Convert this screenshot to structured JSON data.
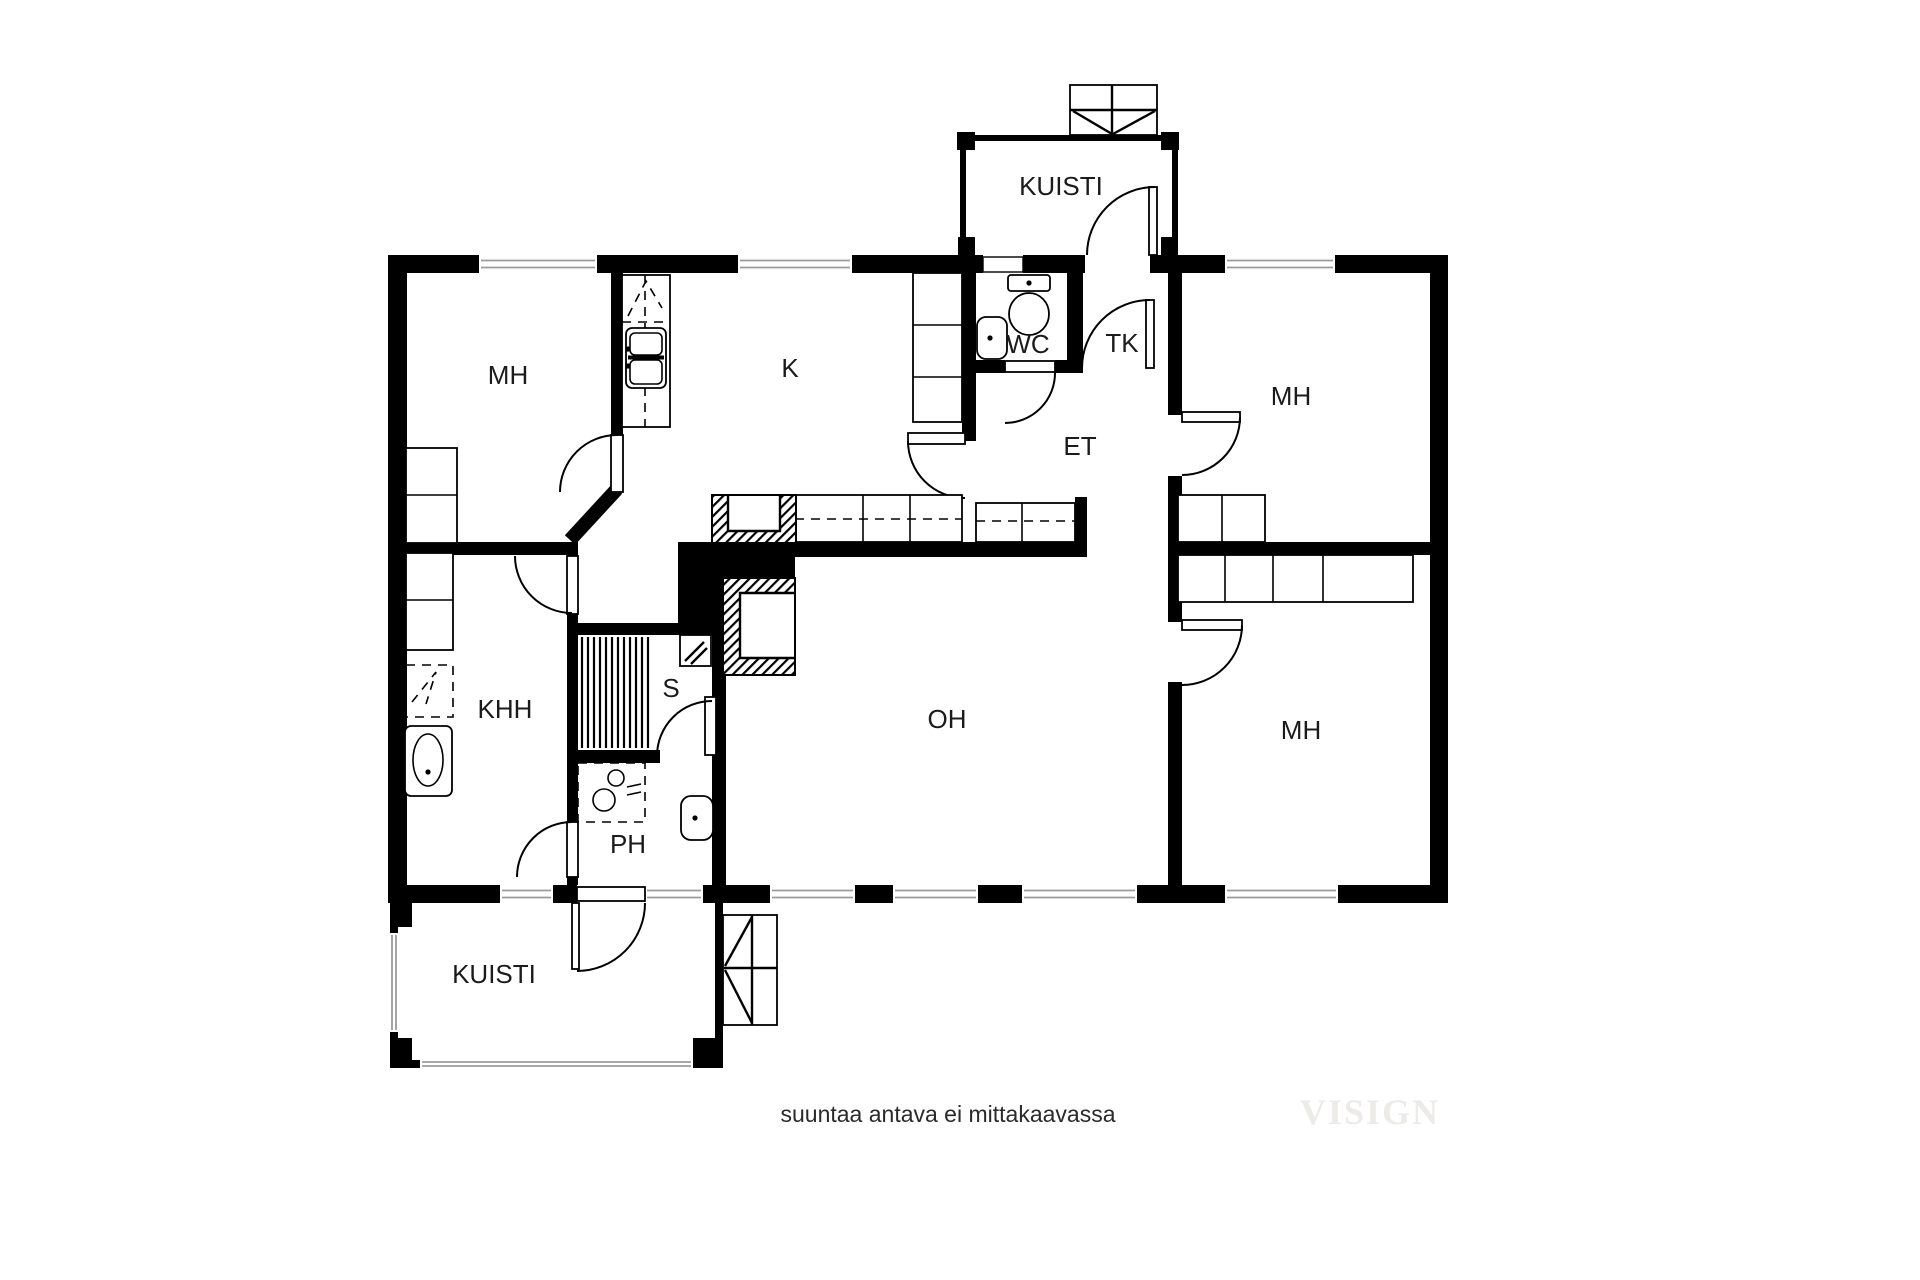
{
  "page": {
    "background": "#ffffff"
  },
  "colors": {
    "wall": "#000000",
    "floor": "#ffffff",
    "window_line": "#9b9b9b",
    "watermark": "#edebe8"
  },
  "rooms": {
    "mh_top_left": {
      "label": "MH"
    },
    "kitchen": {
      "label": "K"
    },
    "kuisti_top": {
      "label": "KUISTI"
    },
    "wc": {
      "label": "WC"
    },
    "tk": {
      "label": "TK"
    },
    "et": {
      "label": "ET"
    },
    "mh_top_right": {
      "label": "MH"
    },
    "khh": {
      "label": "KHH"
    },
    "sauna": {
      "label": "S"
    },
    "ph": {
      "label": "PH"
    },
    "oh": {
      "label": "OH"
    },
    "mh_bottom_right": {
      "label": "MH"
    },
    "kuisti_bottom": {
      "label": "KUISTI"
    }
  },
  "icons": {
    "fixtures": [
      "toilet-icon",
      "sink-icon",
      "double-sink-icon",
      "shower-icon",
      "washing-machine-icon",
      "sauna-stove-icon",
      "sauna-benches-icon",
      "fireplace-icon",
      "stairs-icon",
      "wardrobe",
      "kitchen-counter",
      "window",
      "door-arc"
    ]
  },
  "note": {
    "text": "suuntaa antava ei mittakaavassa"
  },
  "watermark": {
    "text": "VISIGN"
  }
}
